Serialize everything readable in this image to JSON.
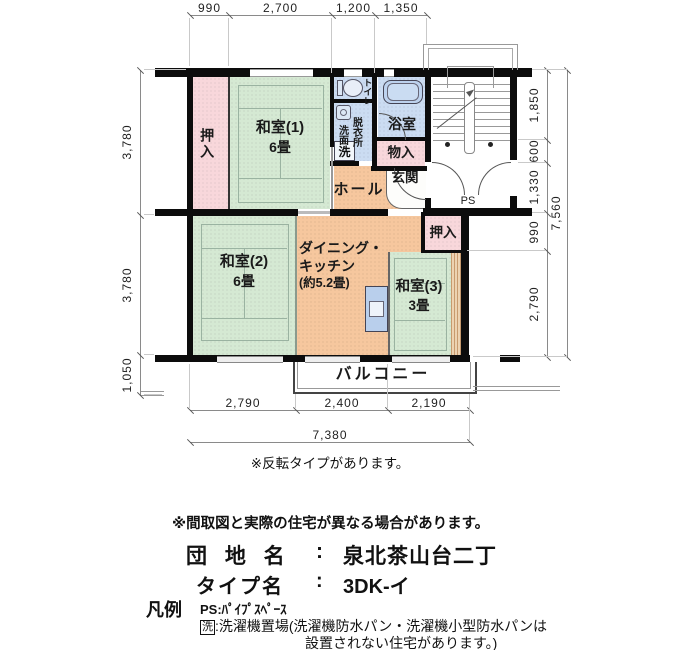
{
  "plan": {
    "rooms": {
      "oshiire1": "押入",
      "washitsu1": "和室(1)",
      "washitsu1_size": "6畳",
      "toilet": "トイレ",
      "senmen": "洗面",
      "datsui": "脱衣所",
      "laundry_mark": "洗",
      "bath": "浴室",
      "mononyu": "物入",
      "genkan": "玄関",
      "hall": "ホール",
      "oshiire2": "押入",
      "washitsu2": "和室(2)",
      "washitsu2_size": "6畳",
      "dk1": "ダイニング・",
      "dk2": "キッチン",
      "dk3": "(約5.2畳)",
      "washitsu3": "和室(3)",
      "washitsu3_size": "3畳",
      "balcony": "バルコニー",
      "ps": "PS"
    },
    "dims": {
      "top": [
        "990",
        "2,700",
        "1,200",
        "1,350"
      ],
      "left": [
        "3,780",
        "3,780",
        "1,050"
      ],
      "right": [
        "1,850",
        "600",
        "1,330",
        "990",
        "2,790"
      ],
      "right_total": "7,560",
      "bottom": [
        "2,790",
        "2,400",
        "2,190"
      ],
      "bottom_total": "7,380"
    },
    "note_flip": "※反転タイプがあります。"
  },
  "info": {
    "note_layout": "※間取図と実際の住宅が異なる場合があります。",
    "danchi_label": "団 地 名",
    "danchi_colon": ":",
    "danchi_name": "泉北茶山台二丁",
    "type_label": "タイプ名",
    "type_colon": ":",
    "type_name": "3DK-イ",
    "legend_title": "凡例",
    "legend_ps": "PS:ﾊﾟｲﾌﾟｽﾍﾟｰｽ",
    "legend_laundry_mark": "洗",
    "legend_laundry_1": ":洗濯機置場(洗濯機防水パン・洗濯機小型防水パンは",
    "legend_laundry_2": "設置されない住宅があります。)"
  },
  "colors": {
    "wall": "#0c0c0c",
    "tatami": "#d5e9d3",
    "closet": "#f8d7db",
    "kitchen": "#f6c79e",
    "wet": "#cbdcf2",
    "fixture": "#bdd2ee",
    "dim": "#8a8a8a"
  }
}
